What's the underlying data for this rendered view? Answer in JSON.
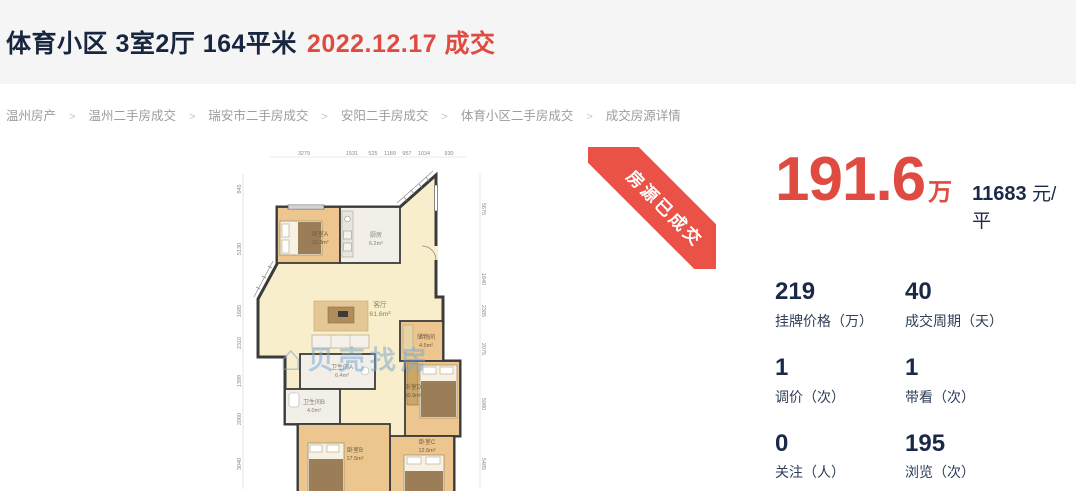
{
  "header": {
    "title": "体育小区 3室2厅 164平米",
    "deal_date": "2022.12.17 成交"
  },
  "breadcrumb": {
    "separator": ">",
    "items": [
      "温州房产",
      "温州二手房成交",
      "瑞安市二手房成交",
      "安阳二手房成交",
      "体育小区二手房成交",
      "成交房源详情"
    ]
  },
  "ribbon": {
    "label": "房源已成交"
  },
  "price": {
    "amount": "191.6",
    "amount_unit": "万",
    "unit_price": "11683",
    "unit_price_suffix": "元/平"
  },
  "stats": [
    {
      "value": "219",
      "label": "挂牌价格（万）"
    },
    {
      "value": "40",
      "label": "成交周期（天）"
    },
    {
      "value": "1",
      "label": "调价（次）"
    },
    {
      "value": "1",
      "label": "带看（次）"
    },
    {
      "value": "0",
      "label": "关注（人）"
    },
    {
      "value": "195",
      "label": "浏览（次）"
    }
  ],
  "floorplan": {
    "watermark_icon": "⌂",
    "watermark_text": "贝壳找房",
    "rooms": [
      {
        "name": "卧室A",
        "area": "10.3m²"
      },
      {
        "name": "厨房",
        "area": "6.2m²"
      },
      {
        "name": "客厅",
        "area": "61.6m²"
      },
      {
        "name": "储物间",
        "area": "4.5m²"
      },
      {
        "name": "卫生间A",
        "area": "6.4m²"
      },
      {
        "name": "卫生间B",
        "area": "4.0m²"
      },
      {
        "name": "卧室D",
        "area": "10.9m²"
      },
      {
        "name": "卧室C",
        "area": "12.6m²"
      },
      {
        "name": "卧室B",
        "area": "17.5m²"
      }
    ],
    "dims_top": [
      "3279",
      "1531",
      "525",
      "1189",
      "957",
      "1034",
      "930"
    ],
    "dims_left": [
      "845",
      "5130",
      "1685",
      "2310",
      "1399",
      "2060",
      "3040"
    ],
    "dims_right": [
      "5675",
      "1840",
      "2385",
      "2075",
      "5980",
      "5485"
    ]
  },
  "colors": {
    "accent_red": "#df4b41",
    "ribbon_red": "#ea5247",
    "dark_navy": "#1b2949",
    "header_band": "#f5f5f6"
  }
}
